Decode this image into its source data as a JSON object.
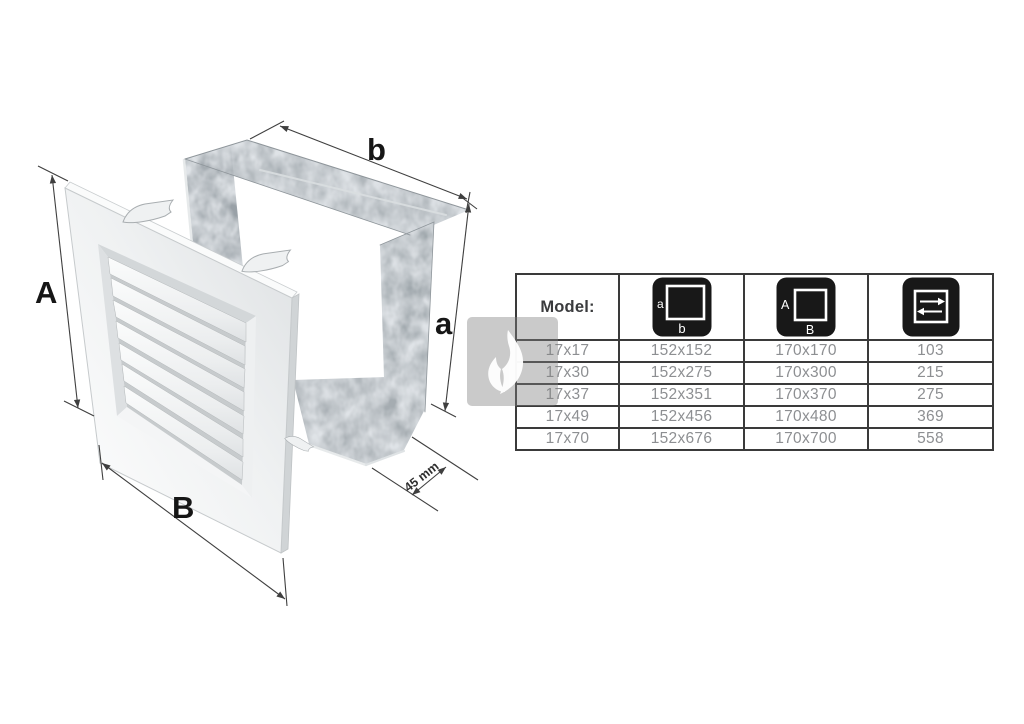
{
  "colors": {
    "table_border": "#3a3a3a",
    "icon_background": "#181818",
    "data_text": "#8d8f92",
    "label_text": "#3a3b3d",
    "dimension_line": "#3f3f3f",
    "watermark_gray": "#c8c8c8",
    "metal_gray": "#a9b0b5",
    "grille_white": "#f1f2f3"
  },
  "diagram": {
    "labels": {
      "grille_height": "A",
      "grille_width": "B",
      "frame_width": "b",
      "frame_height": "a",
      "frame_depth": "45 mm"
    }
  },
  "watermark": {
    "icon": "flame"
  },
  "table": {
    "header": {
      "model_label": "Model:",
      "inner_dim_icon": {
        "name": "inner-dimensions-icon",
        "side_label": "a",
        "bottom_label": "b"
      },
      "outer_dim_icon": {
        "name": "outer-dimensions-icon",
        "side_label": "A",
        "bottom_label": "B"
      },
      "airflow_icon": {
        "name": "airflow-arrows-icon"
      }
    },
    "rows": [
      {
        "model": "17x17",
        "inner_dimensions": "152x152",
        "outer_dimensions": "170x170",
        "airflow": "103"
      },
      {
        "model": "17x30",
        "inner_dimensions": "152x275",
        "outer_dimensions": "170x300",
        "airflow": "215"
      },
      {
        "model": "17x37",
        "inner_dimensions": "152x351",
        "outer_dimensions": "170x370",
        "airflow": "275"
      },
      {
        "model": "17x49",
        "inner_dimensions": "152x456",
        "outer_dimensions": "170x480",
        "airflow": "369"
      },
      {
        "model": "17x70",
        "inner_dimensions": "152x676",
        "outer_dimensions": "170x700",
        "airflow": "558"
      }
    ]
  }
}
